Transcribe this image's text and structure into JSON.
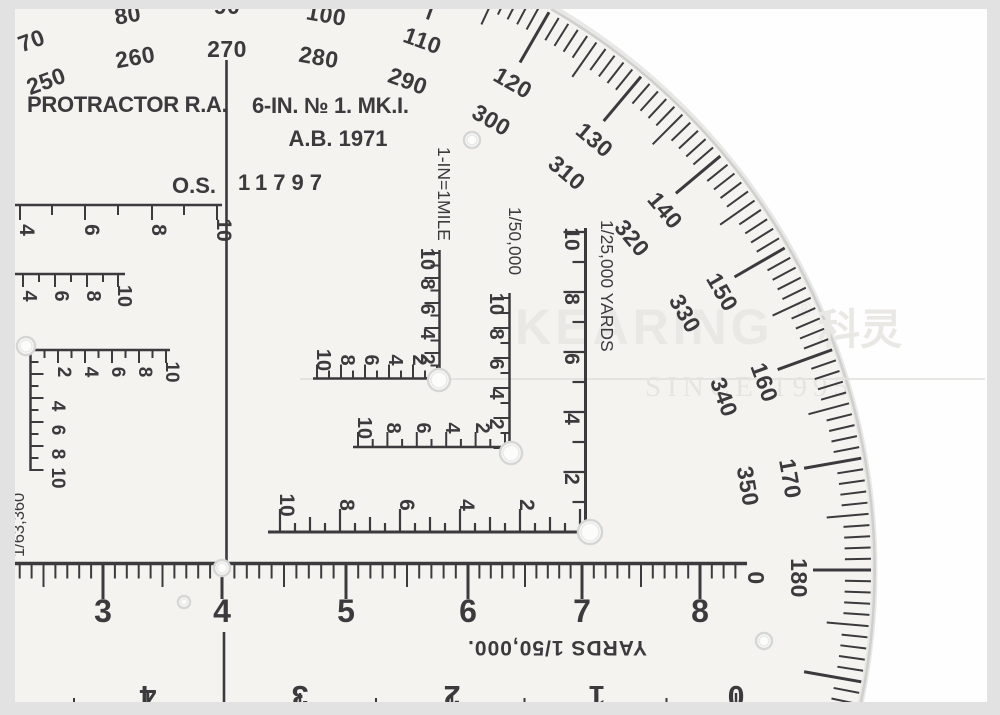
{
  "photo": {
    "frame_color": "#e2e2e2",
    "background": "#fefefe",
    "plastic_color": "#f4f3f0",
    "ink_color": "#3b3a3c",
    "edge_color": "#cfcfcd",
    "hole_ring_color": "#d6d6d4",
    "hole_fill_color": "#fcfcfb"
  },
  "title_block": {
    "maker_label": "PROTRACTOR R.A.",
    "model_label": "6-IN. № 1. MK.I.",
    "year_label": "A.B. 1971",
    "os_prefix": "O.S.",
    "serial_number": "11797"
  },
  "watermark": {
    "brand": "KEARING",
    "registered_mark": "®",
    "brand_cjk": "科灵",
    "tagline": "SINCE 1995",
    "color": "#eae8e4",
    "line_color": "#e0ded9"
  },
  "degree_ring": {
    "outer_degrees": [
      70,
      80,
      90,
      100,
      110,
      120,
      130,
      140,
      150,
      160,
      170,
      180
    ],
    "inner_degrees": [
      250,
      260,
      270,
      280,
      290,
      300,
      310,
      320,
      330,
      340,
      350,
      0
    ]
  },
  "bottom_ruler": {
    "unit_label": "YARDS 1/50,000.",
    "numbers": [
      3,
      4,
      5,
      6,
      7,
      8
    ]
  },
  "bottom_edge_scale": {
    "numbers": [
      4,
      3,
      2,
      1,
      0
    ]
  },
  "mile_scale": {
    "label": "1-IN=1MILE",
    "vertical_numbers": [
      10,
      8,
      6,
      4,
      2
    ],
    "horizontal_numbers": [
      10,
      8,
      6,
      4,
      2
    ]
  },
  "scale_50000": {
    "label": "1/50,000",
    "vertical_numbers": [
      10,
      8,
      6,
      4,
      2
    ],
    "horizontal_numbers": [
      10,
      8,
      6,
      4,
      2
    ]
  },
  "scale_25000": {
    "label": "1/25,000 YARDS",
    "vertical_numbers": [
      10,
      8,
      6,
      4,
      2
    ],
    "horizontal_numbers": [
      10,
      8,
      6,
      4,
      2
    ]
  },
  "scale_63360": {
    "label": "1/63,360",
    "vertical_numbers": [
      4,
      6,
      8,
      10
    ],
    "horizontal_numbers": [
      2,
      4,
      6,
      8,
      10
    ]
  },
  "edge_scales": [
    {
      "numbers": [
        4,
        6,
        8,
        10
      ]
    },
    {
      "numbers": [
        4,
        6,
        8,
        10
      ]
    }
  ]
}
